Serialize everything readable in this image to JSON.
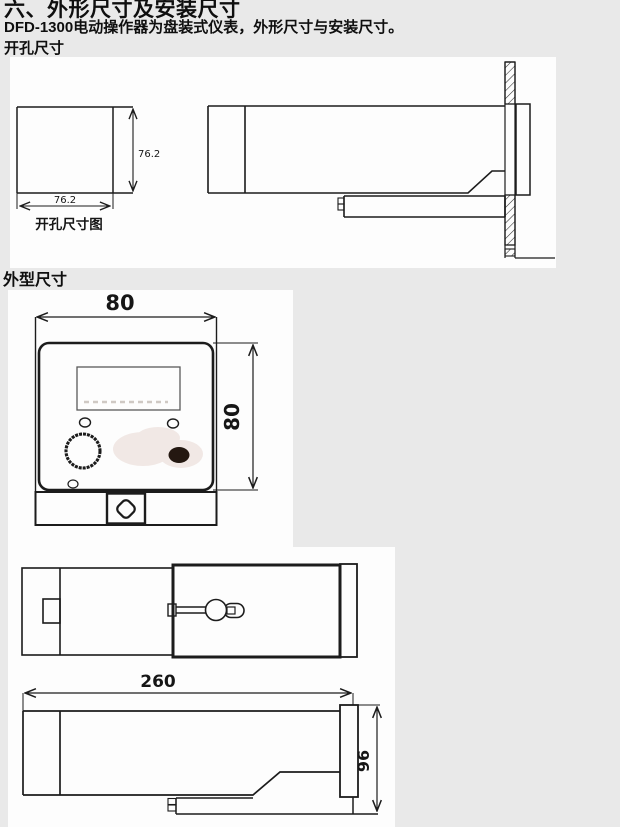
{
  "page": {
    "heading": "六、外形尺寸及安装尺寸",
    "intro": "DFD-1300电动操作器为盘装式仪表，外形尺寸与安装尺寸。",
    "cutout_section_label": "开孔尺寸",
    "outline_section_label": "外型尺寸"
  },
  "cutout_drawing": {
    "caption": "开孔尺寸图",
    "width": "76.2",
    "height": "76.2"
  },
  "front_view": {
    "width": "80",
    "height": "80"
  },
  "side_view": {
    "depth": "260",
    "height": "96"
  },
  "colors": {
    "page_bg": "#e9e9e9",
    "paper": "#fdfdfd",
    "line": "#1c1c1c",
    "smudge": "#f1e8e5",
    "dark_button": "#241811"
  }
}
